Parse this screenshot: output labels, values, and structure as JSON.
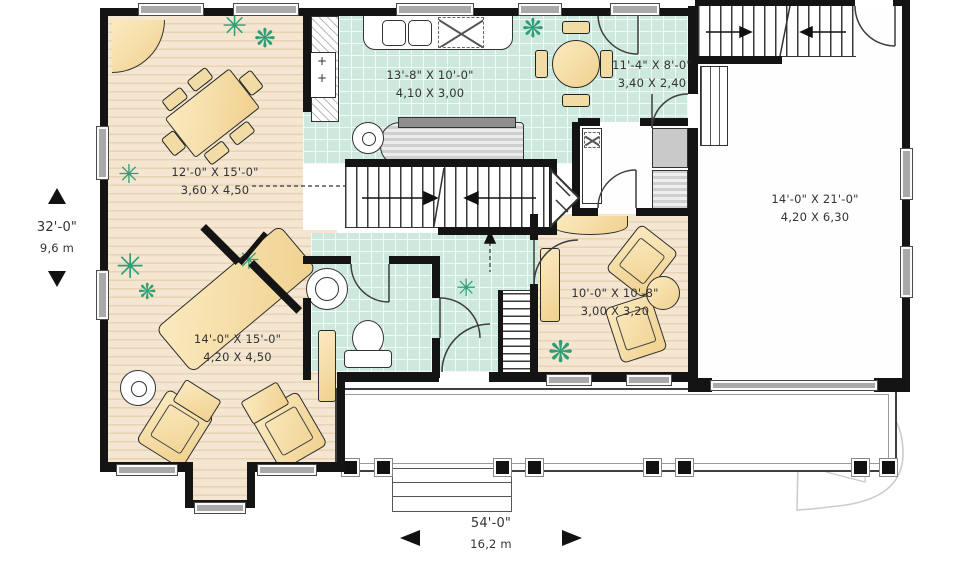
{
  "palette": {
    "tile": "#cde9dd",
    "wood": "#f2e2cb",
    "furniture": "#f6dda4",
    "plant": "#2f9e78",
    "wall": "#141414",
    "window_gray": "#a9a9a9"
  },
  "icons": {
    "plant_burst": "✳",
    "plant_bush": "❋",
    "stove_burner": "+"
  },
  "rooms": [
    {
      "name": "kitchen",
      "imperial": "13'-8\" X 10'-0\"",
      "metric": "4,10 X 3,00"
    },
    {
      "name": "breakfast",
      "imperial": "11'-4\" X 8'-0\"",
      "metric": "3,40 X 2,40"
    },
    {
      "name": "dining",
      "imperial": "12'-0\" X 15'-0\"",
      "metric": "3,60 X 4,50"
    },
    {
      "name": "garage",
      "imperial": "14'-0\" X 21'-0\"",
      "metric": "4,20 X 6,30"
    },
    {
      "name": "living",
      "imperial": "14'-0\" X 15'-0\"",
      "metric": "4,20 X 4,50"
    },
    {
      "name": "den",
      "imperial": "10'-0\" X 10'-8\"",
      "metric": "3,00 X 3,20"
    }
  ],
  "overall_dimensions": {
    "depth": {
      "imperial": "32'-0\"",
      "metric": "9,6 m"
    },
    "width": {
      "imperial": "54'-0\"",
      "metric": "16,2 m"
    }
  }
}
